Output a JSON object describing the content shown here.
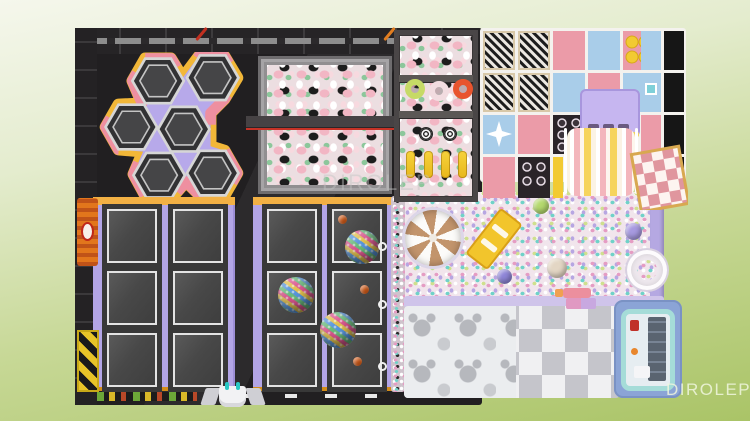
{
  "image": {
    "type": "3d-render-top-view",
    "subject": "indoor playground trampoline park floor plan",
    "watermark": {
      "center_text": "DIROLEP",
      "corner_text": "DIROLEP"
    }
  },
  "palette": {
    "background_top": "#f5f7ec",
    "background_bottom": "#aac467",
    "floor_black": "#211f21",
    "pad_lavender": "#b3a5e6",
    "band_orange": "#f0a01c",
    "edge_pink": "#ee8fa0",
    "edge_yellow": "#f2b738",
    "foam_pink": "#f2b6c4",
    "foam_green": "#8cc79b",
    "structure_pink": "#eb9ba8",
    "structure_blue": "#a9cde9",
    "frame_white": "#f4f2ee",
    "slide_yellow": "#f6d45c",
    "slide_pink": "#f3b6bc",
    "ballpit_pink": "#e59cc3",
    "ballpit_teal": "#6fd2c8",
    "mat_white": "#f0f0f2",
    "mat_gray": "#c5c5cb",
    "playhouse_blue": "#8ba4d6",
    "playhouse_teal": "#a5dcd8",
    "carousel_tan": "#c2946c"
  },
  "zones": {
    "hex_cluster": {
      "name": "hexagon trampoline cluster",
      "hexagons": 6
    },
    "foam_pits": {
      "name": "foam cube pits",
      "pits": 2
    },
    "ninja_lane": {
      "name": "ninja course over foam",
      "rings": 3,
      "targets": 2,
      "bags": 4
    },
    "soft_play": {
      "name": "soft play climbing structure",
      "rollers": 4
    },
    "slide": {
      "name": "wave slide"
    },
    "ball_pit": {
      "name": "ball pit play floor",
      "spinner_discs": 1,
      "loose_balls": 5
    },
    "trampoline_court": {
      "name": "square trampoline court",
      "blocks": 2,
      "mats_per_block": 6,
      "disco_balls": 3,
      "orange_balls": 3
    },
    "toddler_mats": {
      "name": "toddler puzzle mat area"
    },
    "playhouse": {
      "name": "toddler playhouse"
    }
  }
}
